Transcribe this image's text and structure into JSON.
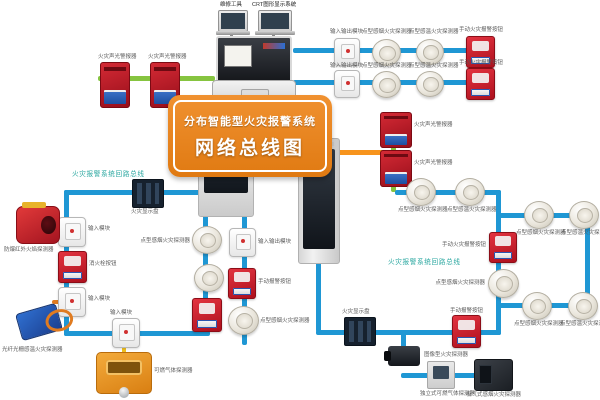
{
  "banner": {
    "line1": "分布智能型火灾报警系统",
    "line2": "网络总线图"
  },
  "top": {
    "laptop_left_label": "维修工具",
    "laptop_right_label": "CRT图形显示系统"
  },
  "loop_labels": {
    "left": "火灾报警系统回路总线",
    "right": "火灾报警系统回路总线"
  },
  "colors": {
    "bus_blue": "#1f97d4",
    "bus_green": "#86c440",
    "bus_orange": "#f7941d",
    "cable_yellow": "#f0c020",
    "cable_orange": "#e07b20",
    "banner_orange": "#e8821c",
    "teal_label": "#2aa7a0",
    "device_red": "#c8102e",
    "stand_gray": "#8a8a8a"
  },
  "lines": [
    {
      "n": "laptop-stand",
      "x": 230,
      "y": 30,
      "w": 3,
      "h": 9,
      "c": "#8a8a8a"
    },
    {
      "n": "laptop-stand",
      "x": 272,
      "y": 30,
      "w": 3,
      "h": 9,
      "c": "#8a8a8a"
    },
    {
      "n": "green-bus-left",
      "x": 98,
      "y": 76,
      "w": 117,
      "h": 5,
      "c": "#86c440"
    },
    {
      "n": "blue-bus-row1",
      "x": 293,
      "y": 48,
      "w": 186,
      "h": 5,
      "c": "#1f97d4"
    },
    {
      "n": "blue-bus-row2",
      "x": 293,
      "y": 80,
      "w": 186,
      "h": 5,
      "c": "#1f97d4"
    },
    {
      "n": "orange-bus",
      "x": 255,
      "y": 150,
      "w": 143,
      "h": 5,
      "c": "#f7941d"
    },
    {
      "n": "green-bus-right",
      "x": 391,
      "y": 112,
      "w": 5,
      "h": 80,
      "c": "#86c440"
    },
    {
      "n": "blue-loop-right",
      "x": 395,
      "y": 190,
      "w": 106,
      "h": 5,
      "c": "#1f97d4"
    },
    {
      "n": "blue-loop-right",
      "x": 496,
      "y": 190,
      "w": 5,
      "h": 145,
      "c": "#1f97d4"
    },
    {
      "n": "blue-loop-right",
      "x": 496,
      "y": 213,
      "w": 94,
      "h": 5,
      "c": "#1f97d4"
    },
    {
      "n": "blue-loop-right",
      "x": 585,
      "y": 213,
      "w": 5,
      "h": 95,
      "c": "#1f97d4"
    },
    {
      "n": "blue-loop-right",
      "x": 496,
      "y": 303,
      "w": 92,
      "h": 5,
      "c": "#1f97d4"
    },
    {
      "n": "blue-loop-bottom",
      "x": 316,
      "y": 330,
      "w": 185,
      "h": 5,
      "c": "#1f97d4"
    },
    {
      "n": "blue-drop-cabinet",
      "x": 316,
      "y": 262,
      "w": 5,
      "h": 70,
      "c": "#1f97d4"
    },
    {
      "n": "blue-branch",
      "x": 401,
      "y": 333,
      "w": 5,
      "h": 32,
      "c": "#1f97d4"
    },
    {
      "n": "blue-branch",
      "x": 401,
      "y": 373,
      "w": 92,
      "h": 5,
      "c": "#1f97d4"
    },
    {
      "n": "blue-loop-left",
      "x": 64,
      "y": 190,
      "w": 136,
      "h": 5,
      "c": "#1f97d4"
    },
    {
      "n": "blue-loop-left",
      "x": 64,
      "y": 190,
      "w": 5,
      "h": 146,
      "c": "#1f97d4"
    },
    {
      "n": "blue-loop-left",
      "x": 64,
      "y": 331,
      "w": 146,
      "h": 5,
      "c": "#1f97d4"
    },
    {
      "n": "blue-drop-panel-left",
      "x": 203,
      "y": 215,
      "w": 5,
      "h": 120,
      "c": "#1f97d4"
    },
    {
      "n": "blue-drop-panel-right",
      "x": 242,
      "y": 215,
      "w": 5,
      "h": 130,
      "c": "#1f97d4"
    },
    {
      "n": "yellow-cable",
      "x": 42,
      "y": 224,
      "w": 18,
      "h": 4,
      "c": "#f0c020"
    },
    {
      "n": "orange-cable",
      "x": 52,
      "y": 300,
      "w": 12,
      "h": 4,
      "c": "#e07b20"
    },
    {
      "n": "yellow-cable",
      "x": 122,
      "y": 344,
      "w": 4,
      "h": 12,
      "c": "#f0c020"
    }
  ],
  "nodes": [
    {
      "n": "laptop",
      "t": "laptop",
      "x": 218,
      "y": 10,
      "w": 28,
      "h": 20,
      "label": "维修工具",
      "lx": 220,
      "ly": 2
    },
    {
      "n": "laptop",
      "t": "laptop",
      "x": 258,
      "y": 10,
      "w": 32,
      "h": 20,
      "label": "CRT图形显示系统",
      "lx": 252,
      "ly": 2
    },
    {
      "n": "sound-light-alarm",
      "t": "alarm",
      "x": 100,
      "y": 62,
      "w": 28,
      "h": 44,
      "label": "火灾声光警报器",
      "lx": 98,
      "ly": 54
    },
    {
      "n": "sound-light-alarm",
      "t": "alarm",
      "x": 150,
      "y": 62,
      "w": 28,
      "h": 44,
      "label": "火灾声光警报器",
      "lx": 148,
      "ly": 54
    },
    {
      "n": "io-module",
      "t": "module",
      "x": 334,
      "y": 38,
      "w": 24,
      "h": 26,
      "label": "输入输出模块",
      "lx": 330,
      "ly": 29
    },
    {
      "n": "smoke-detector",
      "t": "smoke",
      "x": 372,
      "y": 39,
      "w": 27,
      "h": 25,
      "label": "点型感烟火灾探测器",
      "lx": 362,
      "ly": 29
    },
    {
      "n": "heat-detector",
      "t": "smoke",
      "x": 416,
      "y": 39,
      "w": 26,
      "h": 24,
      "label": "点型感温火灾探测器",
      "lx": 409,
      "ly": 29
    },
    {
      "n": "manual-call-point",
      "t": "callpoint",
      "x": 466,
      "y": 36,
      "w": 27,
      "h": 30,
      "label": "手动火灾报警按钮",
      "lx": 459,
      "ly": 27
    },
    {
      "n": "io-module",
      "t": "module",
      "x": 334,
      "y": 70,
      "w": 24,
      "h": 26,
      "label": "输入输出模块",
      "lx": 330,
      "ly": 63
    },
    {
      "n": "smoke-detector",
      "t": "smoke",
      "x": 372,
      "y": 71,
      "w": 27,
      "h": 25,
      "label": "点型感烟火灾探测器",
      "lx": 362,
      "ly": 63
    },
    {
      "n": "heat-detector",
      "t": "smoke",
      "x": 416,
      "y": 71,
      "w": 26,
      "h": 24,
      "label": "点型感温火灾探测器",
      "lx": 409,
      "ly": 63
    },
    {
      "n": "manual-call-point",
      "t": "callpoint",
      "x": 466,
      "y": 68,
      "w": 27,
      "h": 30,
      "label": "手动火灾报警按钮",
      "lx": 459,
      "ly": 60
    },
    {
      "n": "sound-light-alarm",
      "t": "alarm",
      "x": 380,
      "y": 112,
      "w": 30,
      "h": 34,
      "label": "火灾声光警报器",
      "lx": 414,
      "ly": 122
    },
    {
      "n": "sound-light-alarm",
      "t": "alarm",
      "x": 380,
      "y": 150,
      "w": 30,
      "h": 35,
      "label": "火灾声光警报器",
      "lx": 414,
      "ly": 160
    },
    {
      "n": "fire-display-panel",
      "t": "display",
      "x": 132,
      "y": 179,
      "w": 30,
      "h": 27,
      "label": "火灾显示盘",
      "lx": 131,
      "ly": 209
    },
    {
      "n": "input-module",
      "t": "module",
      "x": 58,
      "y": 217,
      "w": 26,
      "h": 28,
      "label": "输入模块",
      "lx": 88,
      "ly": 226
    },
    {
      "n": "flame-detector",
      "t": "flame",
      "x": 16,
      "y": 206,
      "w": 42,
      "h": 36,
      "label": "防爆红外火焰探测器",
      "lx": 4,
      "ly": 247
    },
    {
      "n": "hydrant-button",
      "t": "callpoint",
      "x": 58,
      "y": 251,
      "w": 27,
      "h": 30,
      "label": "消火栓按钮",
      "lx": 89,
      "ly": 261
    },
    {
      "n": "input-module",
      "t": "module",
      "x": 58,
      "y": 287,
      "w": 26,
      "h": 28,
      "label": "输入模块",
      "lx": 88,
      "ly": 296
    },
    {
      "n": "fiber-heat-detector",
      "t": "fiber",
      "x": 18,
      "y": 308,
      "w": 40,
      "h": 26,
      "label": "光纤光栅感温火灾探测器",
      "lx": 2,
      "ly": 347
    },
    {
      "n": "input-module",
      "t": "module",
      "x": 112,
      "y": 318,
      "w": 26,
      "h": 28,
      "label": "输入模块",
      "lx": 110,
      "ly": 310
    },
    {
      "n": "gas-detector",
      "t": "gas",
      "x": 96,
      "y": 352,
      "w": 54,
      "h": 40,
      "label": "可燃气体探测器",
      "lx": 154,
      "ly": 368
    },
    {
      "n": "smoke-detector",
      "t": "smoke",
      "x": 192,
      "y": 226,
      "w": 28,
      "h": 26,
      "label": "点型感烟火灾探测器",
      "lx": 190,
      "ly": 238,
      "la": "right"
    },
    {
      "n": "smoke-detector",
      "t": "smoke",
      "x": 194,
      "y": 264,
      "w": 28,
      "h": 26
    },
    {
      "n": "manual-call-point",
      "t": "callpoint",
      "x": 192,
      "y": 298,
      "w": 28,
      "h": 32
    },
    {
      "n": "io-module",
      "t": "module",
      "x": 229,
      "y": 228,
      "w": 25,
      "h": 27,
      "label": "输入输出模块",
      "lx": 258,
      "ly": 239
    },
    {
      "n": "manual-call-point",
      "t": "callpoint",
      "x": 228,
      "y": 268,
      "w": 26,
      "h": 29,
      "label": "手动报警按钮",
      "lx": 258,
      "ly": 279
    },
    {
      "n": "smoke-detector",
      "t": "smoke",
      "x": 228,
      "y": 306,
      "w": 29,
      "h": 27,
      "label": "点型感烟火灾探测器",
      "lx": 260,
      "ly": 318
    },
    {
      "n": "smoke-detector",
      "t": "smoke",
      "x": 406,
      "y": 178,
      "w": 28,
      "h": 26,
      "label": "点型感烟火灾探测器",
      "lx": 398,
      "ly": 207
    },
    {
      "n": "heat-detector",
      "t": "smoke",
      "x": 455,
      "y": 178,
      "w": 28,
      "h": 26,
      "label": "点型感温火灾探测器",
      "lx": 447,
      "ly": 207
    },
    {
      "n": "smoke-detector",
      "t": "smoke",
      "x": 524,
      "y": 201,
      "w": 28,
      "h": 26,
      "label": "点型感烟火灾探测器",
      "lx": 516,
      "ly": 230
    },
    {
      "n": "heat-detector",
      "t": "smoke",
      "x": 569,
      "y": 201,
      "w": 28,
      "h": 26,
      "label": "点型感温火灾探测器",
      "lx": 561,
      "ly": 230
    },
    {
      "n": "manual-call-point",
      "t": "callpoint",
      "x": 489,
      "y": 232,
      "w": 26,
      "h": 29,
      "label": "手动火灾报警按钮",
      "lx": 486,
      "ly": 242,
      "la": "right"
    },
    {
      "n": "smoke-detector",
      "t": "smoke",
      "x": 488,
      "y": 269,
      "w": 29,
      "h": 27,
      "label": "点型感烟火灾探测器",
      "lx": 485,
      "ly": 280,
      "la": "right"
    },
    {
      "n": "smoke-detector",
      "t": "smoke",
      "x": 522,
      "y": 292,
      "w": 28,
      "h": 26,
      "label": "点型感烟火灾探测器",
      "lx": 514,
      "ly": 321
    },
    {
      "n": "heat-detector",
      "t": "smoke",
      "x": 568,
      "y": 292,
      "w": 28,
      "h": 26,
      "label": "点型感温火灾探测器",
      "lx": 560,
      "ly": 321
    },
    {
      "n": "fire-display-panel",
      "t": "display",
      "x": 344,
      "y": 317,
      "w": 30,
      "h": 27,
      "label": "火灾显示盘",
      "lx": 342,
      "ly": 309
    },
    {
      "n": "manual-call-point",
      "t": "callpoint",
      "x": 452,
      "y": 315,
      "w": 27,
      "h": 31,
      "label": "手动报警按钮",
      "lx": 450,
      "ly": 308
    },
    {
      "n": "image-fire-detector",
      "t": "camera",
      "x": 388,
      "y": 346,
      "w": 32,
      "h": 20,
      "label": "图像型火灾探测器",
      "lx": 424,
      "ly": 352
    },
    {
      "n": "standalone-gas-detector",
      "t": "smallpanel",
      "x": 427,
      "y": 361,
      "w": 26,
      "h": 26,
      "label": "独立式可燃气体探测器",
      "lx": 420,
      "ly": 391
    },
    {
      "n": "aspirating-smoke-detector",
      "t": "darkbox",
      "x": 474,
      "y": 359,
      "w": 37,
      "h": 30,
      "label": "吸气式感烟火灾探测器",
      "lx": 466,
      "ly": 392
    }
  ]
}
